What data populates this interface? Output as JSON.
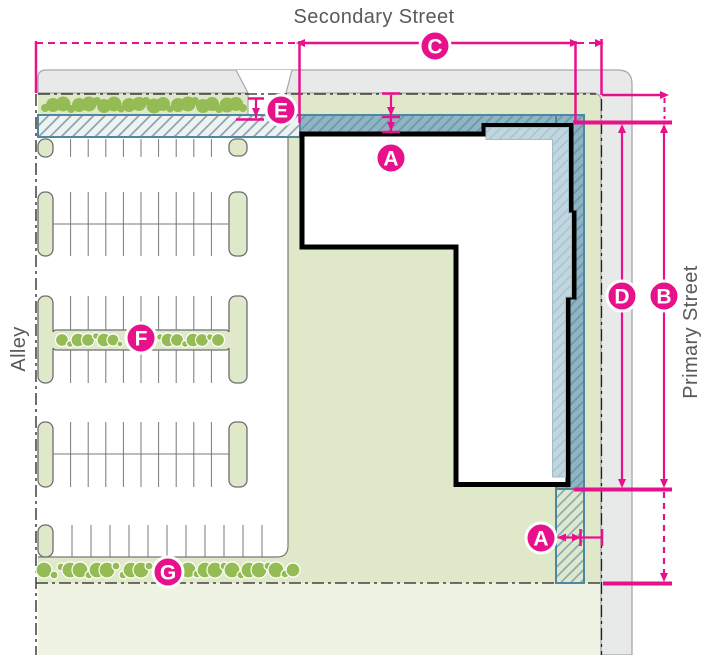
{
  "streets": {
    "secondary": "Secondary Street",
    "primary": "Primary Street",
    "alley": "Alley"
  },
  "markers": [
    {
      "id": "c",
      "label": "C",
      "x": 435,
      "y": 46
    },
    {
      "id": "e",
      "label": "E",
      "x": 281,
      "y": 110
    },
    {
      "id": "a-top",
      "label": "A",
      "x": 391,
      "y": 158
    },
    {
      "id": "f",
      "label": "F",
      "x": 141,
      "y": 338
    },
    {
      "id": "d",
      "label": "D",
      "x": 622,
      "y": 296
    },
    {
      "id": "b",
      "label": "B",
      "x": 664,
      "y": 296
    },
    {
      "id": "a-bottom",
      "label": "A",
      "x": 541,
      "y": 538
    },
    {
      "id": "g",
      "label": "G",
      "x": 168,
      "y": 572
    }
  ],
  "colors": {
    "accent_pink": "#E8118C",
    "lawn": "#E0E8CA",
    "lawn_adjacent": "#EFF3E3",
    "street_gray": "#E8E9E9",
    "street_border": "#A6A8AB",
    "band_teal": "#8FB5C3",
    "band_teal_hatch": "#6B99AD",
    "band_border": "#4F86A0",
    "band_light": "#C2D6E0",
    "band_light_hatch": "#A8C4D1",
    "band_over_lawn_hatch": "#7FA6B9",
    "setback_fill": "#EDF2F3",
    "setback_hatch": "#8A9BA4",
    "shrub_green": "#95BB55",
    "building_outline": "#000000",
    "street_label_gray": "#58595B",
    "stall_line_gray": "#77787B",
    "island_outline": "#6D6E71",
    "parcel_line": "#231F20"
  }
}
